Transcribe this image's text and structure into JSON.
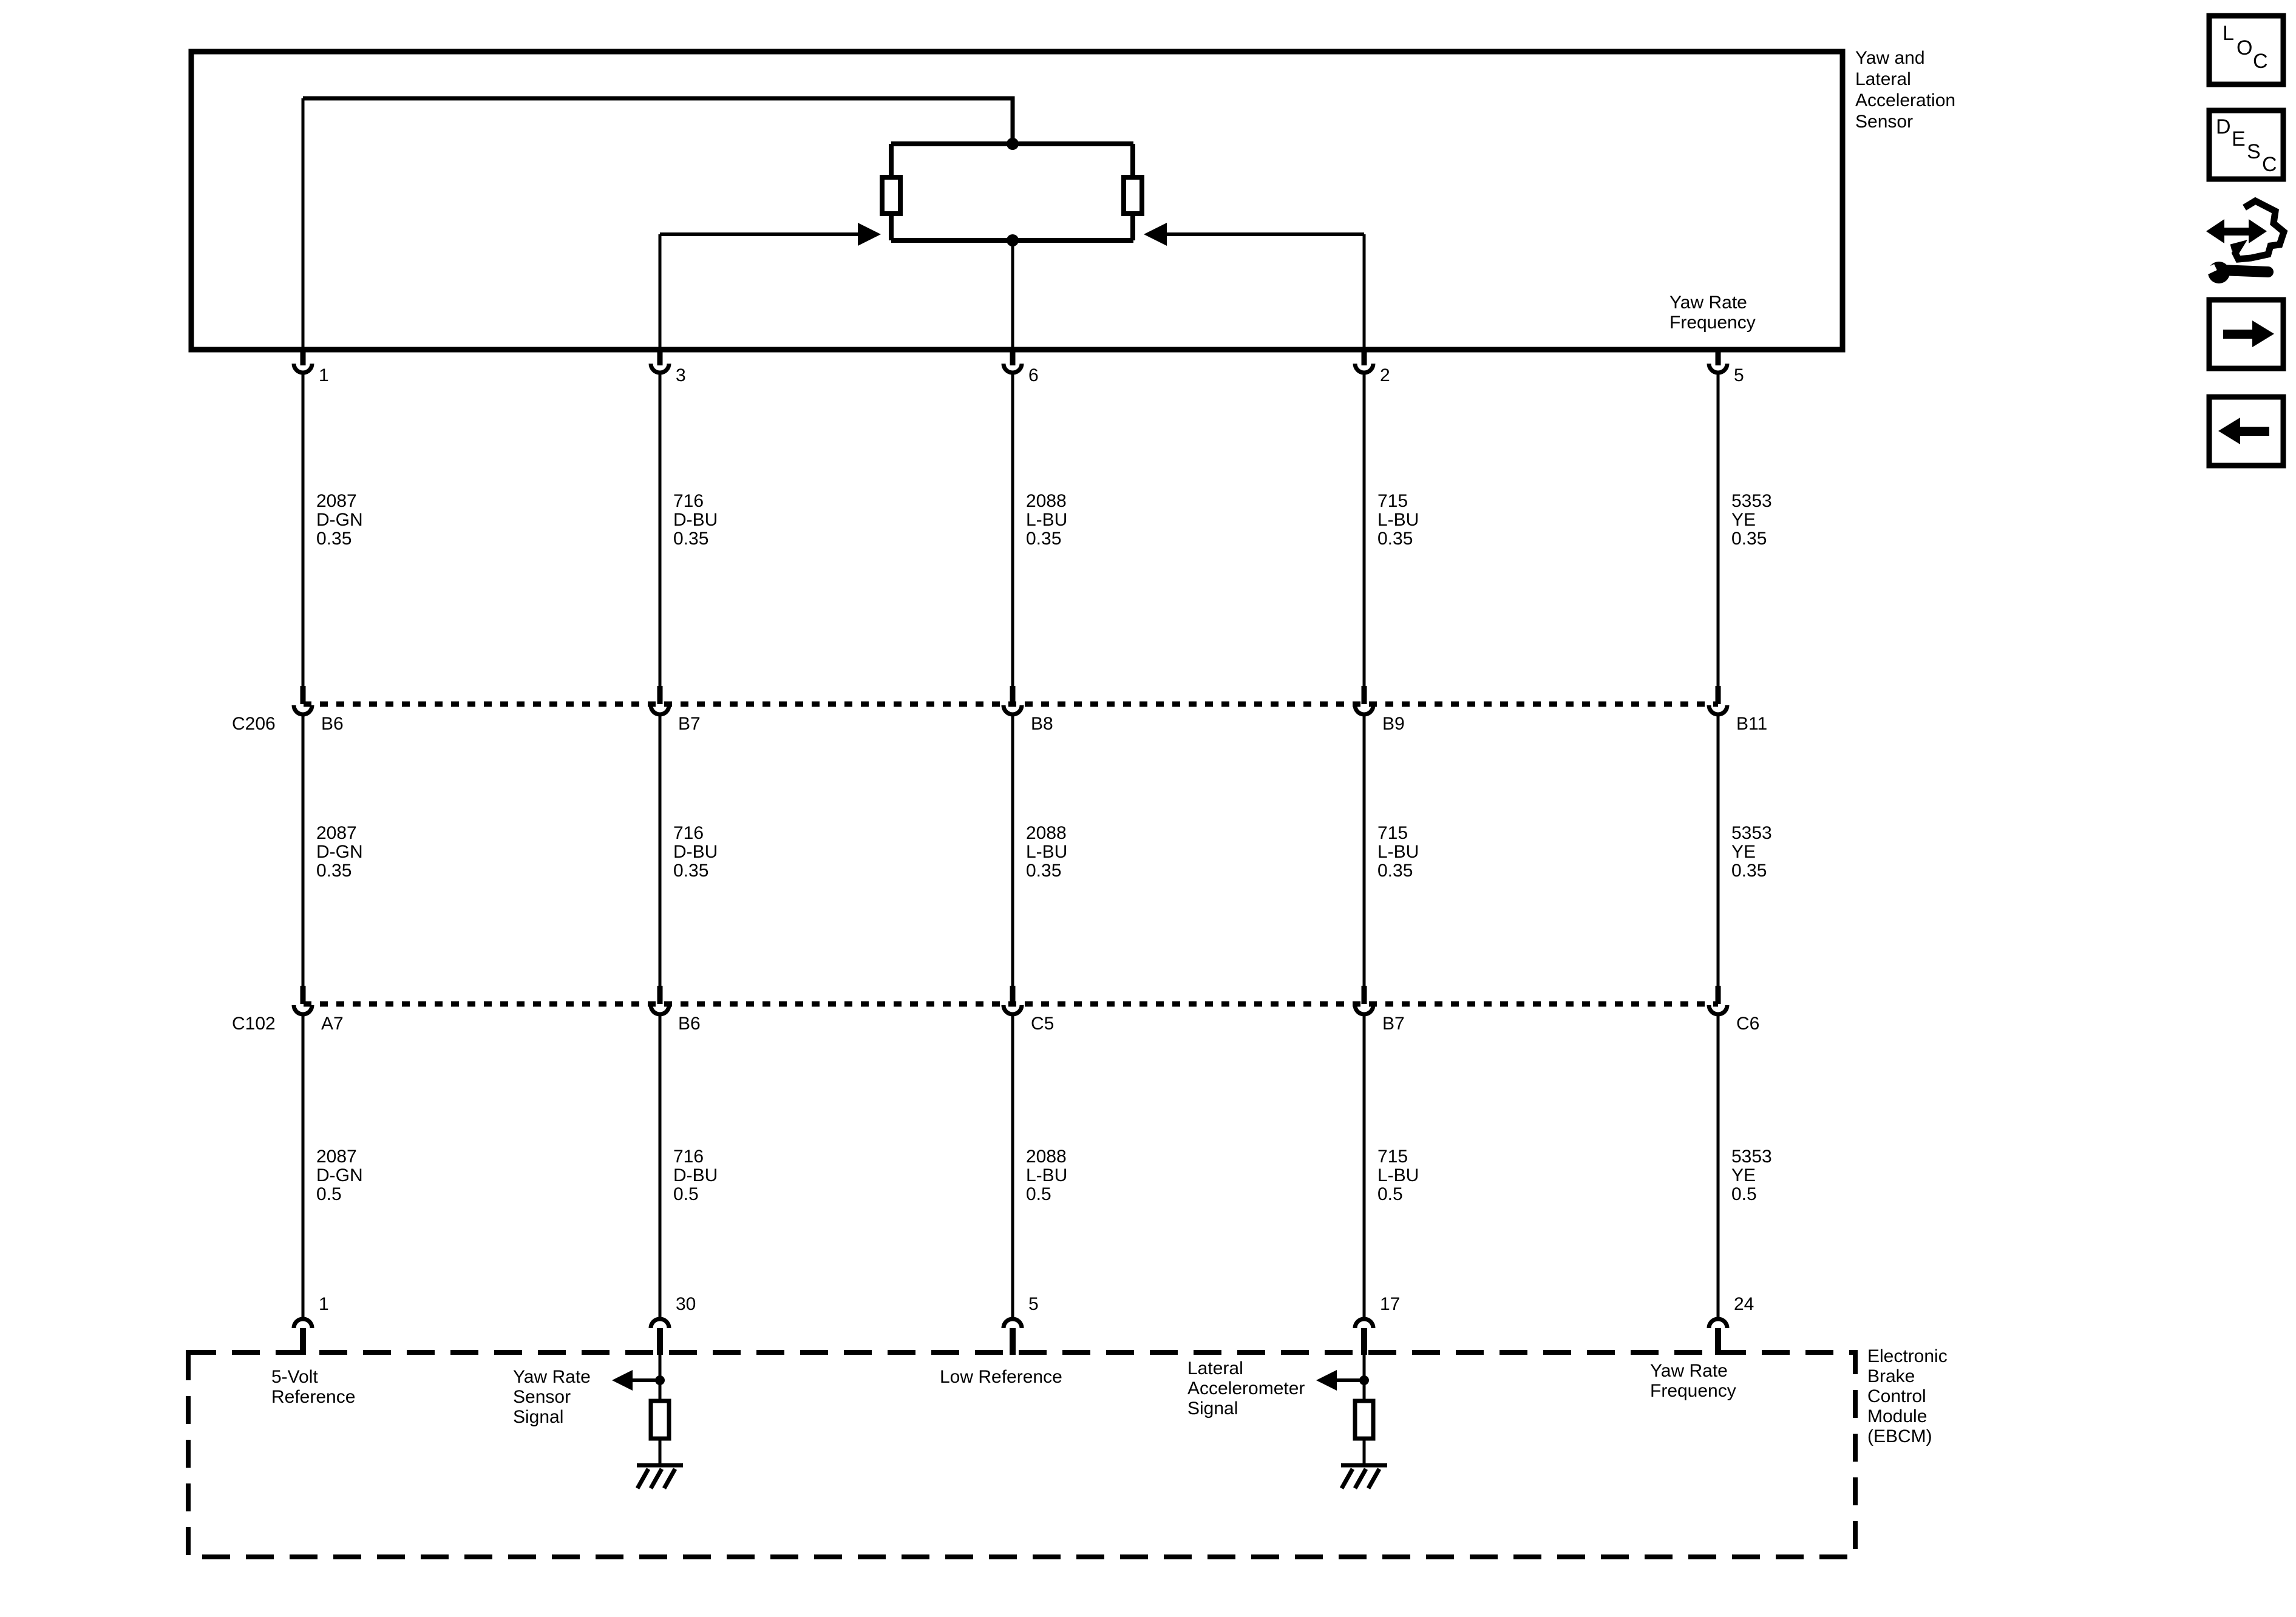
{
  "diagram_title": "Yaw and Lateral Acceleration Sensor wiring schematic",
  "sensor": {
    "label_lines": [
      "Yaw and",
      "Lateral",
      "Acceleration",
      "Sensor"
    ],
    "internal_label_lines": [
      "Yaw Rate",
      "Frequency"
    ]
  },
  "inline_connectors": {
    "c206": "C206",
    "c102": "C102"
  },
  "columns": [
    {
      "top_pin": "1",
      "wire_upper": {
        "circuit": "2087",
        "color": "D-GN",
        "gauge": "0.35"
      },
      "c206_pin": "B6",
      "wire_middle": {
        "circuit": "2087",
        "color": "D-GN",
        "gauge": "0.35"
      },
      "c102_pin": "A7",
      "wire_lower": {
        "circuit": "2087",
        "color": "D-GN",
        "gauge": "0.5"
      },
      "bottom_pin": "1",
      "ebcm_signal_lines": [
        "5-Volt",
        "Reference"
      ]
    },
    {
      "top_pin": "3",
      "wire_upper": {
        "circuit": "716",
        "color": "D-BU",
        "gauge": "0.35"
      },
      "c206_pin": "B7",
      "wire_middle": {
        "circuit": "716",
        "color": "D-BU",
        "gauge": "0.35"
      },
      "c102_pin": "B6",
      "wire_lower": {
        "circuit": "716",
        "color": "D-BU",
        "gauge": "0.5"
      },
      "bottom_pin": "30",
      "ebcm_signal_lines": [
        "Yaw Rate",
        "Sensor",
        "Signal"
      ]
    },
    {
      "top_pin": "6",
      "wire_upper": {
        "circuit": "2088",
        "color": "L-BU",
        "gauge": "0.35"
      },
      "c206_pin": "B8",
      "wire_middle": {
        "circuit": "2088",
        "color": "L-BU",
        "gauge": "0.35"
      },
      "c102_pin": "C5",
      "wire_lower": {
        "circuit": "2088",
        "color": "L-BU",
        "gauge": "0.5"
      },
      "bottom_pin": "5",
      "ebcm_signal_lines": [
        "Low Reference"
      ]
    },
    {
      "top_pin": "2",
      "wire_upper": {
        "circuit": "715",
        "color": "L-BU",
        "gauge": "0.35"
      },
      "c206_pin": "B9",
      "wire_middle": {
        "circuit": "715",
        "color": "L-BU",
        "gauge": "0.35"
      },
      "c102_pin": "B7",
      "wire_lower": {
        "circuit": "715",
        "color": "L-BU",
        "gauge": "0.5"
      },
      "bottom_pin": "17",
      "ebcm_signal_lines": [
        "Lateral",
        "Accelerometer",
        "Signal"
      ]
    },
    {
      "top_pin": "5",
      "wire_upper": {
        "circuit": "5353",
        "color": "YE",
        "gauge": "0.35"
      },
      "c206_pin": "B11",
      "wire_middle": {
        "circuit": "5353",
        "color": "YE",
        "gauge": "0.35"
      },
      "c102_pin": "C6",
      "wire_lower": {
        "circuit": "5353",
        "color": "YE",
        "gauge": "0.5"
      },
      "bottom_pin": "24",
      "ebcm_signal_lines": [
        "Yaw Rate",
        "Frequency"
      ]
    }
  ],
  "ebcm": {
    "label_lines": [
      "Electronic",
      "Brake",
      "Control",
      "Module",
      "(EBCM)"
    ]
  },
  "toolbar": {
    "loc_letters": [
      "L",
      "O",
      "C"
    ],
    "desc_letters": [
      "D",
      "E",
      "S",
      "C"
    ]
  },
  "colors": {
    "line": "#000000",
    "background": "#ffffff"
  }
}
